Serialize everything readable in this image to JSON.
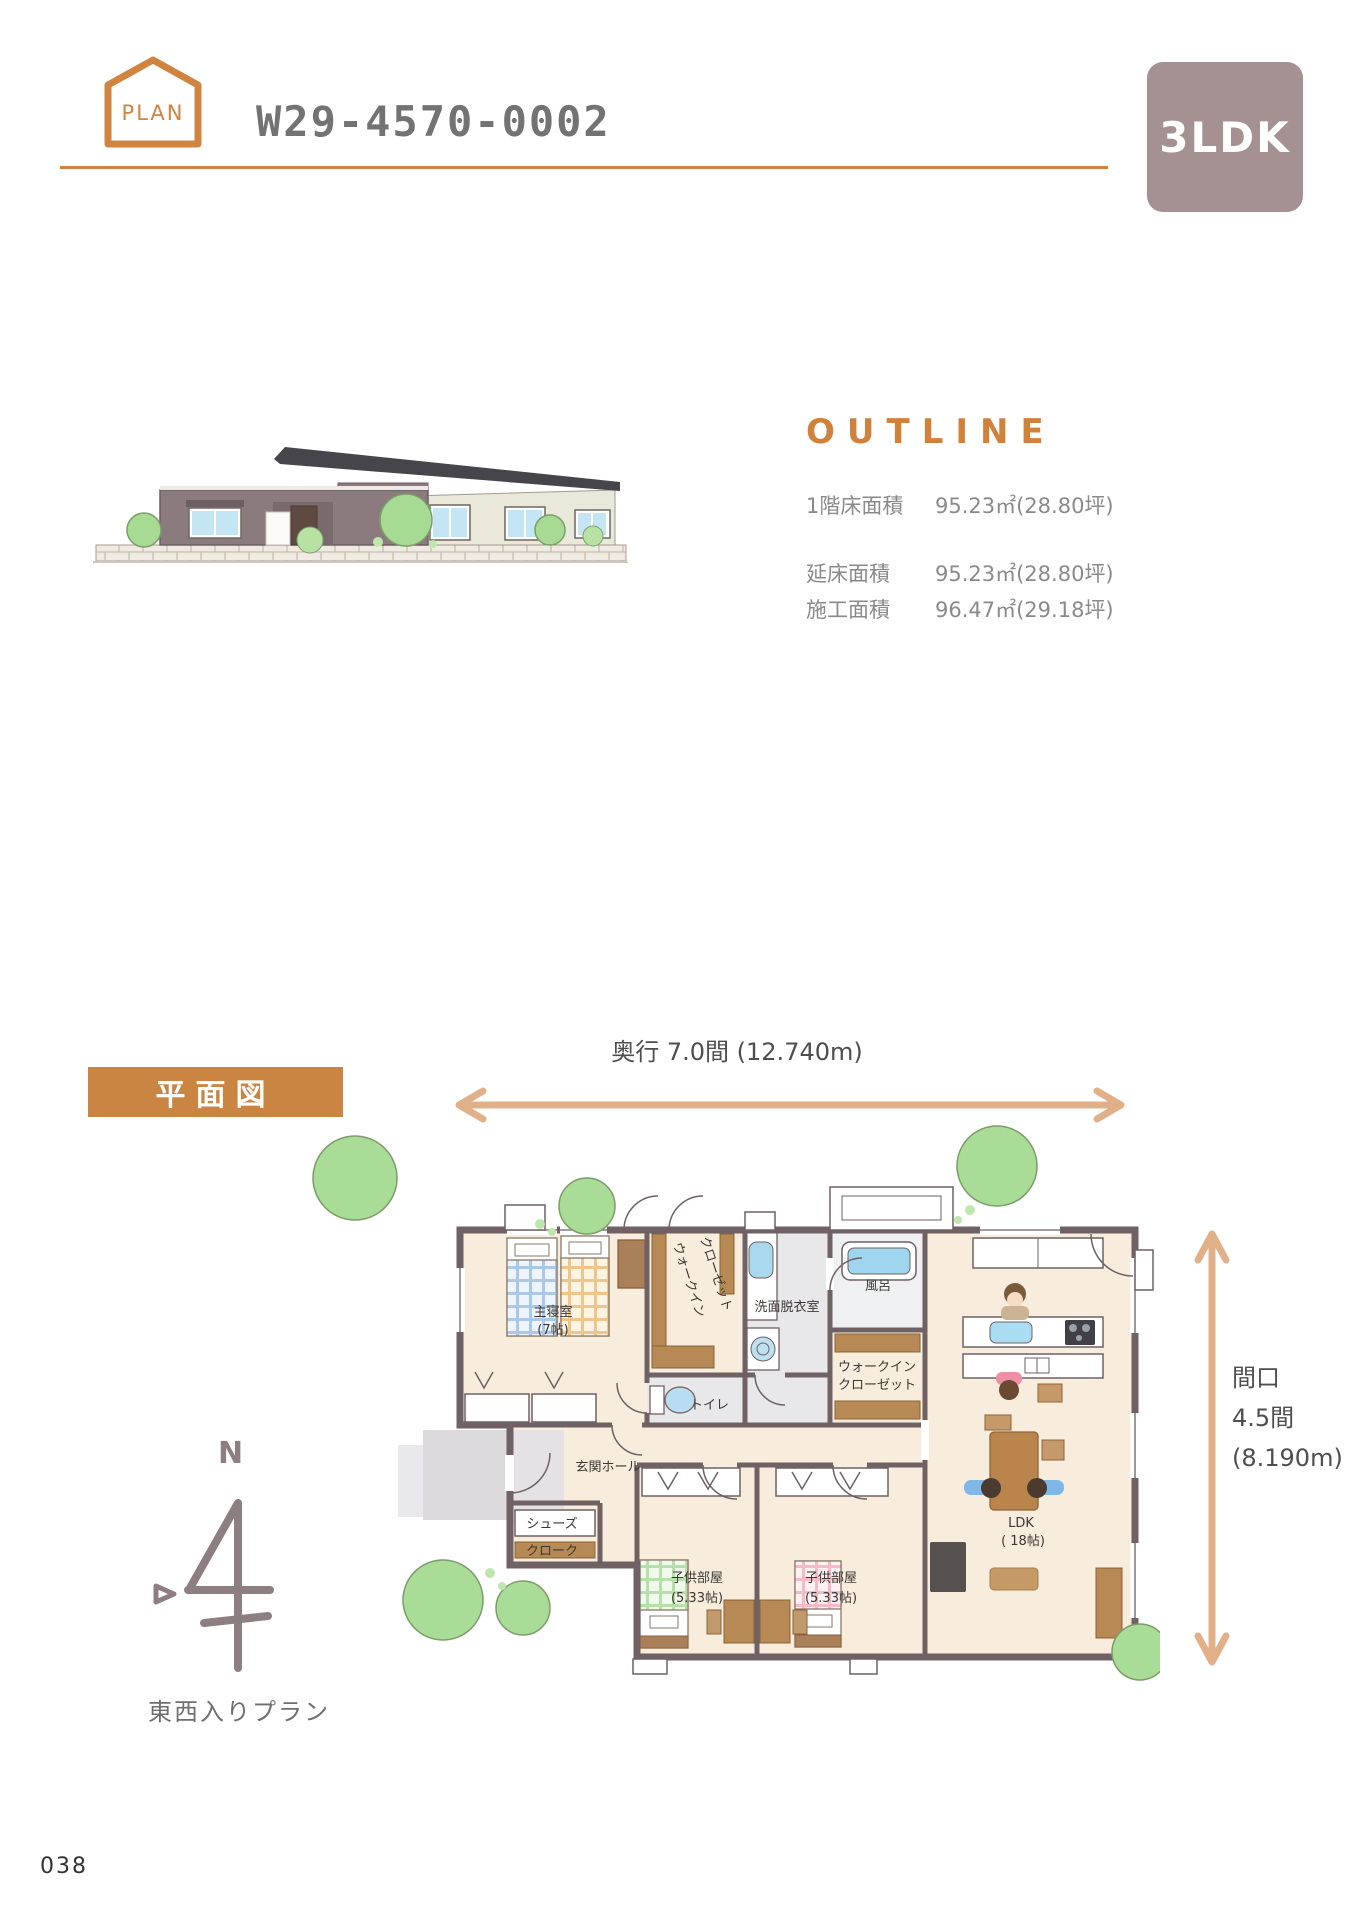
{
  "header": {
    "badge": "PLAN",
    "code": "W29-4570-0002",
    "type": "3LDK"
  },
  "outline": {
    "heading": "OUTLINE",
    "specs": [
      {
        "label": "1階床面積",
        "value": "95.23㎡(28.80坪)"
      },
      {
        "label": "延床面積",
        "value": "95.23㎡(28.80坪)"
      },
      {
        "label": "施工面積",
        "value": "96.47㎡(29.18坪)"
      }
    ]
  },
  "floorplan": {
    "section_label": "平面図",
    "depth_dim": "奥行  7.0間 (12.740m)",
    "width_dim_l1": "間口",
    "width_dim_l2": "4.5間",
    "width_dim_l3": "(8.190m)",
    "compass": {
      "north": "N",
      "note": "東西入りプラン"
    },
    "rooms": {
      "master": "主寝室",
      "master_size": "(7帖)",
      "wic_v1": "ウォークイン",
      "wic_v2": "クローゼット",
      "washroom": "洗面脱衣室",
      "bath": "風呂",
      "toilet": "トイレ",
      "wic_m1": "ウォークイン",
      "wic_m2": "クローゼット",
      "hall": "玄関ホール",
      "shoes1": "シューズ",
      "shoes2": "クローク",
      "kids": "子供部屋",
      "kids_size": "(5.33帖)",
      "kids2": "子供部屋",
      "kids2_size": "(5.33帖)",
      "ldk": "LDK",
      "ldk_size": "( 18帖)"
    }
  },
  "footer": {
    "page_number": "038"
  },
  "colors": {
    "accent_orange": "#d08440",
    "badge_mauve": "#a59192",
    "arrow_tan": "#e2b088",
    "spec_gray": "#8a8a8a",
    "wall_brown": "#6f6164",
    "floor_cream": "#f8eddc"
  }
}
